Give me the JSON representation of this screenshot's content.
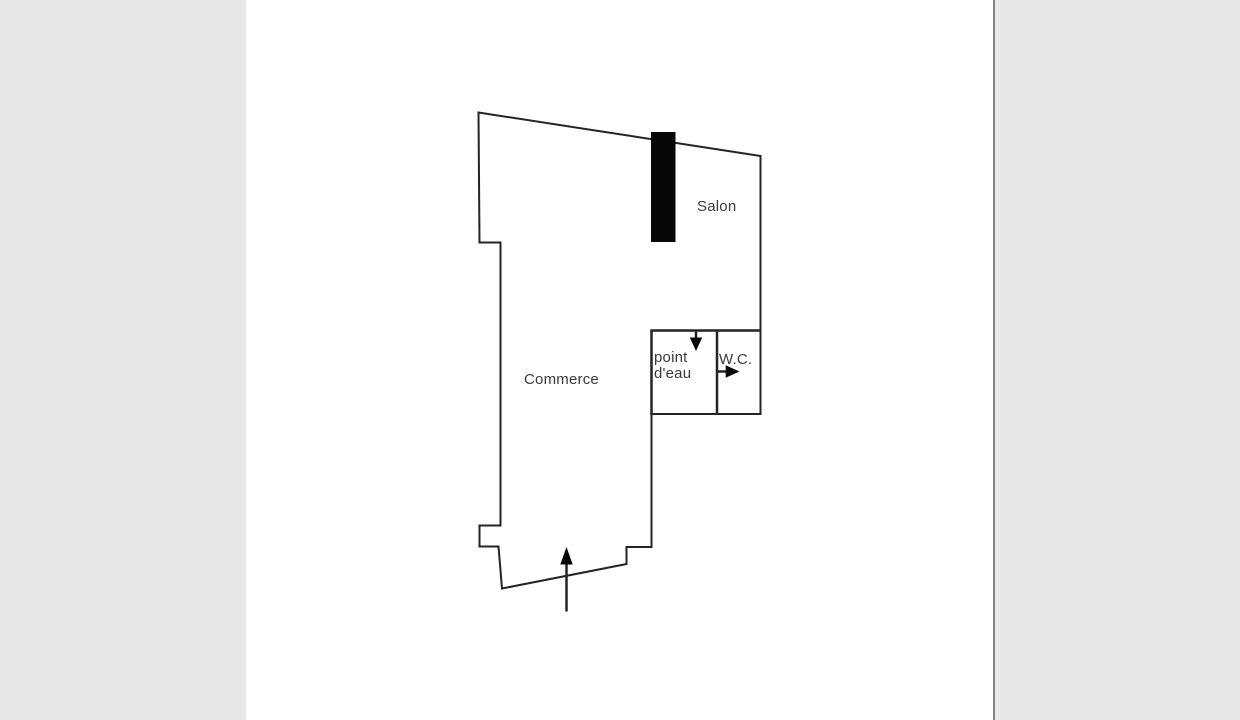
{
  "colors": {
    "canvas": "#ffffff",
    "side_panel": "#e8e8e8",
    "divider": "#848484",
    "line": "#242424",
    "wall_fill": "#070707",
    "text": "#3a3a3a"
  },
  "plan": {
    "title": "Floor plan",
    "labels": {
      "salon": "Salon",
      "commerce": "Commerce",
      "point_eau_line1": "point",
      "point_eau_line2": "d'eau",
      "wc": "W.C."
    },
    "icons": {
      "entrance_arrow": "up-arrow",
      "point_eau_door_arrow": "down-arrow",
      "wc_door_arrow": "right-arrow",
      "dark_wall_segment": "filled-black-rectangle"
    }
  }
}
